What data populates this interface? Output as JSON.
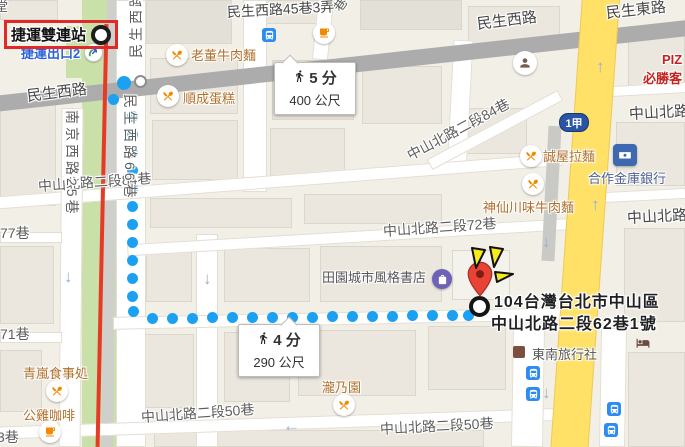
{
  "station": {
    "label": "捷運雙連站",
    "exit_label": "捷運出口2"
  },
  "route_shield": {
    "label": "1甲"
  },
  "badges": {
    "walk1": {
      "time": "5 分",
      "dist": "400 公尺"
    },
    "walk2": {
      "time": "4 分",
      "dist": "290 公尺"
    }
  },
  "destination": {
    "line1": "104台灣台北市中山區",
    "line2": "中山北路二段62巷1號"
  },
  "colors": {
    "route_dot": "#1CA1F2",
    "yellow_road": "#FFE168",
    "major_road": "#ACACAC",
    "rail_red": "#E63A27",
    "green_strip": "#C9E0A9",
    "annotation_red": "#E02A28",
    "burst_yellow": "#F6EA1A",
    "pin_red": "#E94335",
    "poi_brown": "#B06F2A",
    "bus_blue": "#2E8CF0",
    "exit_blue": "#2B63D6"
  },
  "map": {
    "street_labels": [
      {
        "t": "堂",
        "x": -5,
        "y": -4,
        "s": 13,
        "a": 0,
        "main": 0
      },
      {
        "t": "民生西路",
        "x": 27,
        "y": 85,
        "s": 15,
        "a": -7,
        "main": 1
      },
      {
        "t": "民生西路45巷3弄",
        "x": 227,
        "y": 2,
        "s": 14,
        "a": -3,
        "main": 1
      },
      {
        "t": "巷",
        "x": 336,
        "y": 0,
        "s": 13,
        "a": -55,
        "main": 0
      },
      {
        "t": "民生西路",
        "x": 477,
        "y": 13,
        "s": 15,
        "a": -7,
        "main": 1
      },
      {
        "t": "民生東路",
        "x": 606,
        "y": 2,
        "s": 15,
        "a": -6,
        "main": 1
      },
      {
        "t": "中山北路二段84巷",
        "x": 38,
        "y": 176,
        "s": 14,
        "a": -4,
        "main": 0
      },
      {
        "t": "中山北路二段84巷",
        "x": 408,
        "y": 146,
        "s": 14,
        "a": -28,
        "main": 0
      },
      {
        "t": "中山北路二段72巷",
        "x": 383,
        "y": 221,
        "s": 14,
        "a": -4,
        "main": 0
      },
      {
        "t": "中山北路",
        "x": 629,
        "y": 103,
        "s": 15,
        "a": -3,
        "main": 1
      },
      {
        "t": "中山北路",
        "x": 627,
        "y": 207,
        "s": 15,
        "a": -3,
        "main": 1
      },
      {
        "t": "中山北路二段50巷",
        "x": 141,
        "y": 407,
        "s": 14,
        "a": -4,
        "main": 0
      },
      {
        "t": "中山北路二段50巷",
        "x": 380,
        "y": 419,
        "s": 14,
        "a": -3,
        "main": 0
      },
      {
        "t": "77巷",
        "x": 0,
        "y": 223,
        "s": 14,
        "a": 0,
        "main": 0
      },
      {
        "t": "71巷",
        "x": 0,
        "y": 324,
        "s": 14,
        "a": 0,
        "main": 0
      },
      {
        "t": "3巷",
        "x": -3,
        "y": 427,
        "s": 14,
        "a": 0,
        "main": 0
      }
    ],
    "vertical_labels": [
      {
        "t": "民生西路66巷",
        "x": 140,
        "y": 94,
        "dir": "down"
      },
      {
        "t": "南京西路25巷",
        "x": 82,
        "y": 110,
        "dir": "down"
      },
      {
        "t": "民生西路",
        "x": 126,
        "y": 58,
        "dir": "up"
      }
    ],
    "pois": [
      {
        "t": "老董牛肉麵",
        "x": 191,
        "y": 45,
        "cls": "",
        "icon": "food",
        "ix": 177,
        "iy": 55
      },
      {
        "t": "順成蛋糕",
        "x": 183,
        "y": 88,
        "cls": "",
        "icon": "food",
        "ix": 168,
        "iy": 96
      },
      {
        "t": "誠屋拉麵",
        "x": 543,
        "y": 146,
        "cls": "",
        "icon": "food",
        "ix": 531,
        "iy": 156
      },
      {
        "t": "神仙川味牛肉麵",
        "x": 483,
        "y": 197,
        "cls": "",
        "icon": "food",
        "ix": 533,
        "iy": 184
      },
      {
        "t": "合作金庫銀行",
        "x": 588,
        "y": 168,
        "cls": "bank",
        "icon": "bank",
        "ix": 625,
        "iy": 155
      },
      {
        "t": "田園城市風格書店",
        "x": 322,
        "y": 267,
        "cls": "gray",
        "icon": "shop",
        "ix": 442,
        "iy": 279
      },
      {
        "t": "東南旅行社",
        "x": 532,
        "y": 344,
        "cls": "gray",
        "icon": "biz",
        "ix": 519,
        "iy": 352
      },
      {
        "t": "瀧乃園",
        "x": 322,
        "y": 377,
        "cls": "",
        "icon": "food",
        "ix": 344,
        "iy": 405
      },
      {
        "t": "青嵐食事処",
        "x": 23,
        "y": 363,
        "cls": "",
        "icon": "food",
        "ix": 57,
        "iy": 391
      },
      {
        "t": "公雞咖啡",
        "x": 23,
        "y": 405,
        "cls": "",
        "icon": "coffee",
        "ix": 50,
        "iy": 432
      },
      {
        "t": "PIZ",
        "x": 662,
        "y": 52,
        "cls": "red",
        "icon": "",
        "ix": 0,
        "iy": 0
      },
      {
        "t": "必勝客",
        "x": 643,
        "y": 68,
        "cls": "red",
        "icon": "",
        "ix": 0,
        "iy": 0
      },
      {
        "t": "",
        "x": 0,
        "y": 0,
        "cls": "",
        "icon": "coffee",
        "ix": 324,
        "iy": 33
      },
      {
        "t": "",
        "x": 0,
        "y": 0,
        "cls": "",
        "icon": "civic",
        "ix": 525,
        "iy": 63
      },
      {
        "t": "",
        "x": 0,
        "y": 0,
        "cls": "",
        "icon": "bus",
        "ix": 269,
        "iy": 35
      },
      {
        "t": "",
        "x": 0,
        "y": 0,
        "cls": "",
        "icon": "bus",
        "ix": 533,
        "iy": 373
      },
      {
        "t": "",
        "x": 0,
        "y": 0,
        "cls": "",
        "icon": "bus",
        "ix": 533,
        "iy": 394
      },
      {
        "t": "",
        "x": 0,
        "y": 0,
        "cls": "",
        "icon": "bus",
        "ix": 614,
        "iy": 409
      },
      {
        "t": "",
        "x": 0,
        "y": 0,
        "cls": "",
        "icon": "bus",
        "ix": 611,
        "iy": 430
      },
      {
        "t": "",
        "x": 0,
        "y": 0,
        "cls": "",
        "icon": "bed",
        "ix": 643,
        "iy": 343
      }
    ],
    "arrows": [
      {
        "g": "↑",
        "x": 596,
        "y": 58,
        "c": "b"
      },
      {
        "g": "↑",
        "x": 591,
        "y": 196,
        "c": "b"
      },
      {
        "g": "↓",
        "x": 542,
        "y": 233,
        "c": "b"
      },
      {
        "g": "↓",
        "x": 203,
        "y": 270,
        "c": "g"
      },
      {
        "g": "↓",
        "x": 64,
        "y": 268,
        "c": "b"
      },
      {
        "g": "↓",
        "x": 542,
        "y": 384,
        "c": "g"
      },
      {
        "g": "←",
        "x": 283,
        "y": 417,
        "c": "b"
      }
    ],
    "roads": [
      {
        "x": -15,
        "y": 57,
        "w": 730,
        "h": 16,
        "a": -6.25,
        "type": "major"
      },
      {
        "x": 566,
        "y": -12,
        "w": 38,
        "h": 475,
        "a": 4,
        "type": "yellow"
      },
      {
        "x": 545,
        "y": 126,
        "w": 13,
        "h": 135,
        "a": 3,
        "type": "lane"
      },
      {
        "x": 82,
        "y": 0,
        "w": 34,
        "h": 447,
        "a": 0,
        "type": "greenstrip"
      },
      {
        "x": 66,
        "y": 26,
        "w": 46,
        "h": 52,
        "a": 0,
        "type": "greenstrip"
      },
      {
        "x": 104,
        "y": 0,
        "w": 12,
        "h": 447,
        "a": 0.8,
        "type": "railg"
      },
      {
        "x": 100,
        "y": 24,
        "w": 4,
        "h": 423,
        "a": 1.2,
        "type": "railr"
      },
      {
        "x": 116,
        "y": 0,
        "w": 30,
        "h": 447,
        "a": 0,
        "type": "white"
      },
      {
        "x": 243,
        "y": 0,
        "w": 24,
        "h": 192,
        "a": 0,
        "type": "white"
      },
      {
        "x": 196,
        "y": 234,
        "w": 22,
        "h": 213,
        "a": 0,
        "type": "white"
      },
      {
        "x": 450,
        "y": 40,
        "w": 20,
        "h": 132,
        "a": 3,
        "type": "white"
      },
      {
        "x": 315,
        "y": 0,
        "w": 16,
        "h": 60,
        "a": 6,
        "type": "white"
      },
      {
        "x": -12,
        "y": 175,
        "w": 575,
        "h": 13,
        "a": -4.4,
        "type": "white"
      },
      {
        "x": 421,
        "y": 124,
        "w": 148,
        "h": 12,
        "a": -28,
        "type": "white"
      },
      {
        "x": 127,
        "y": 231,
        "w": 450,
        "h": 12,
        "a": -3.4,
        "type": "white"
      },
      {
        "x": 113,
        "y": 312,
        "w": 462,
        "h": 13,
        "a": -1.2,
        "type": "white"
      },
      {
        "x": -10,
        "y": 417,
        "w": 592,
        "h": 13,
        "a": -1.9,
        "type": "white"
      },
      {
        "x": 612,
        "y": 84,
        "w": 76,
        "h": 11,
        "a": -3,
        "type": "white"
      },
      {
        "x": 602,
        "y": 190,
        "w": 84,
        "h": 11,
        "a": -3,
        "type": "white"
      },
      {
        "x": 600,
        "y": 328,
        "w": 26,
        "h": 119,
        "a": 1,
        "type": "white"
      },
      {
        "x": 512,
        "y": 328,
        "w": 32,
        "h": 119,
        "a": 1,
        "type": "white"
      },
      {
        "x": 60,
        "y": 108,
        "w": 22,
        "h": 339,
        "a": 0.5,
        "type": "white"
      },
      {
        "x": 0,
        "y": 232,
        "w": 62,
        "h": 11,
        "a": 0,
        "type": "white"
      },
      {
        "x": 0,
        "y": 332,
        "w": 62,
        "h": 11,
        "a": 0,
        "type": "white"
      }
    ],
    "buildings": [
      {
        "x": 0,
        "y": 0,
        "w": 58,
        "h": 20,
        "v": ""
      },
      {
        "x": 146,
        "y": 0,
        "w": 86,
        "h": 44,
        "v": "d"
      },
      {
        "x": 250,
        "y": 0,
        "w": 74,
        "h": 24,
        "v": ""
      },
      {
        "x": 360,
        "y": 0,
        "w": 102,
        "h": 30,
        "v": "d"
      },
      {
        "x": 468,
        "y": 6,
        "w": 92,
        "h": 44,
        "v": ""
      },
      {
        "x": 628,
        "y": 26,
        "w": 57,
        "h": 62,
        "v": ""
      },
      {
        "x": 616,
        "y": 122,
        "w": 69,
        "h": 64,
        "v": ""
      },
      {
        "x": 150,
        "y": 58,
        "w": 88,
        "h": 56,
        "v": ""
      },
      {
        "x": 152,
        "y": 120,
        "w": 86,
        "h": 60,
        "v": ""
      },
      {
        "x": 272,
        "y": 60,
        "w": 82,
        "h": 60,
        "v": ""
      },
      {
        "x": 362,
        "y": 66,
        "w": 80,
        "h": 58,
        "v": ""
      },
      {
        "x": 270,
        "y": 128,
        "w": 75,
        "h": 48,
        "v": ""
      },
      {
        "x": 455,
        "y": 108,
        "w": 72,
        "h": 46,
        "v": ""
      },
      {
        "x": 150,
        "y": 198,
        "w": 142,
        "h": 30,
        "v": ""
      },
      {
        "x": 304,
        "y": 194,
        "w": 138,
        "h": 30,
        "v": ""
      },
      {
        "x": 146,
        "y": 252,
        "w": 46,
        "h": 50,
        "v": ""
      },
      {
        "x": 224,
        "y": 248,
        "w": 86,
        "h": 54,
        "v": ""
      },
      {
        "x": 320,
        "y": 246,
        "w": 122,
        "h": 56,
        "v": ""
      },
      {
        "x": 452,
        "y": 250,
        "w": 58,
        "h": 50,
        "v": "l"
      },
      {
        "x": 140,
        "y": 334,
        "w": 54,
        "h": 74,
        "v": ""
      },
      {
        "x": 224,
        "y": 332,
        "w": 66,
        "h": 70,
        "v": ""
      },
      {
        "x": 298,
        "y": 330,
        "w": 118,
        "h": 66,
        "v": ""
      },
      {
        "x": 428,
        "y": 326,
        "w": 78,
        "h": 64,
        "v": ""
      },
      {
        "x": 624,
        "y": 228,
        "w": 61,
        "h": 94,
        "v": ""
      },
      {
        "x": 628,
        "y": 352,
        "w": 57,
        "h": 95,
        "v": ""
      },
      {
        "x": 0,
        "y": 104,
        "w": 56,
        "h": 102,
        "v": ""
      },
      {
        "x": 0,
        "y": 246,
        "w": 54,
        "h": 78,
        "v": ""
      },
      {
        "x": 0,
        "y": 350,
        "w": 42,
        "h": 62,
        "v": ""
      },
      {
        "x": 154,
        "y": 430,
        "w": 330,
        "h": 17,
        "v": ""
      }
    ],
    "route_dots": [
      [
        113,
        99
      ],
      [
        132,
        116
      ],
      [
        132,
        134
      ],
      [
        132,
        152
      ],
      [
        132,
        170
      ],
      [
        132,
        188
      ],
      [
        132,
        206
      ],
      [
        132,
        224
      ],
      [
        132,
        242
      ],
      [
        132,
        260
      ],
      [
        132,
        278
      ],
      [
        132,
        296
      ],
      [
        133,
        311
      ],
      [
        152,
        318
      ],
      [
        172,
        318
      ],
      [
        192,
        318
      ],
      [
        212,
        317
      ],
      [
        232,
        317
      ],
      [
        252,
        317
      ],
      [
        272,
        317
      ],
      [
        292,
        317
      ],
      [
        312,
        317
      ],
      [
        332,
        316
      ],
      [
        352,
        316
      ],
      [
        372,
        316
      ],
      [
        392,
        316
      ],
      [
        412,
        315
      ],
      [
        432,
        315
      ],
      [
        452,
        315
      ],
      [
        468,
        315
      ]
    ]
  }
}
